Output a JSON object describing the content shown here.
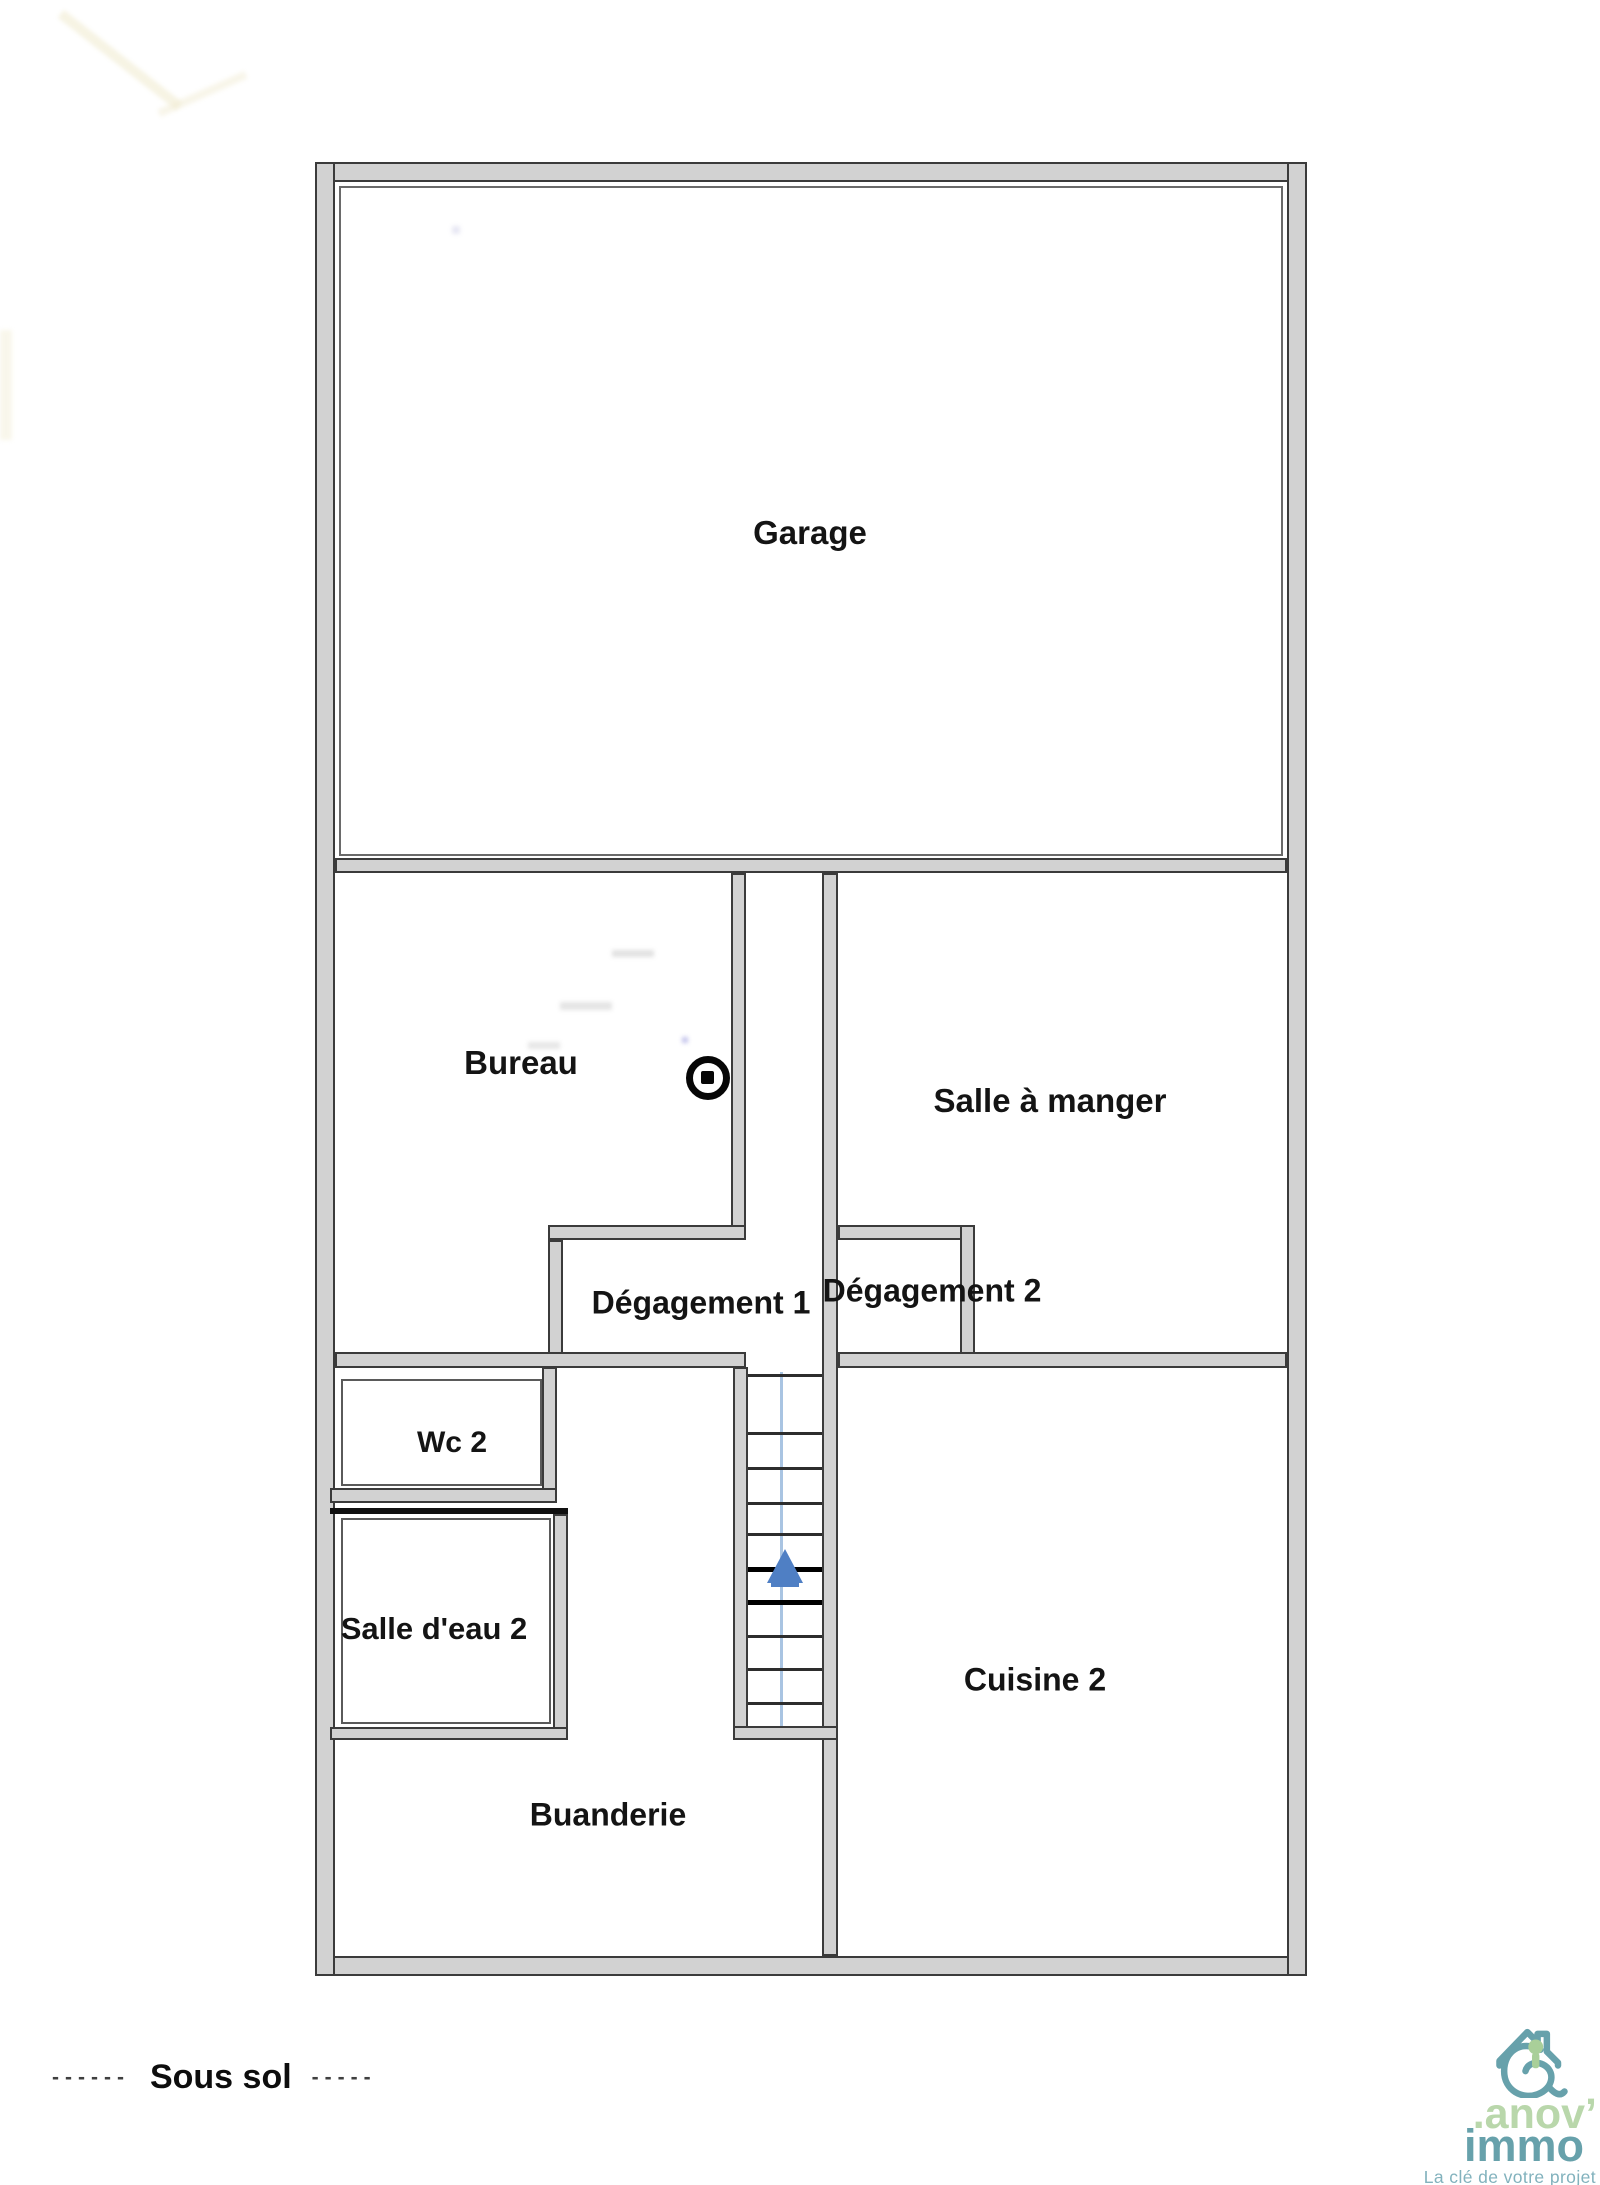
{
  "floor_plan": {
    "rooms": [
      {
        "id": "garage",
        "label": "Garage"
      },
      {
        "id": "bureau",
        "label": "Bureau"
      },
      {
        "id": "salle-a-manger",
        "label": "Salle à manger"
      },
      {
        "id": "degagement-1",
        "label": "Dégagement 1"
      },
      {
        "id": "degagement-2",
        "label": "Dégagement 2"
      },
      {
        "id": "wc-2",
        "label": "Wc 2"
      },
      {
        "id": "salle-d-eau-2",
        "label": "Salle d'eau 2"
      },
      {
        "id": "cuisine-2",
        "label": "Cuisine 2"
      },
      {
        "id": "buanderie",
        "label": "Buanderie"
      }
    ],
    "stairs": {
      "direction": "up",
      "arrow_color": "#4f7fc4",
      "guide_line_color": "#a9c4e2"
    },
    "symbols": {
      "circle_dot_symbol": "circle-with-dot"
    },
    "wall_color": "#d2d2d2",
    "wall_edge_color": "#3b3b3b"
  },
  "footer": {
    "level_label": "Sous sol",
    "dashes_left": "------",
    "dashes_right": "-----"
  },
  "logo": {
    "name_line1": ".anov’",
    "name_line2": "immo",
    "tagline": "La clé de votre projet",
    "colors": {
      "primary_teal": "#67a1ab",
      "accent_green": "#b9d7ab",
      "tagline_teal": "#82b2bd"
    }
  }
}
